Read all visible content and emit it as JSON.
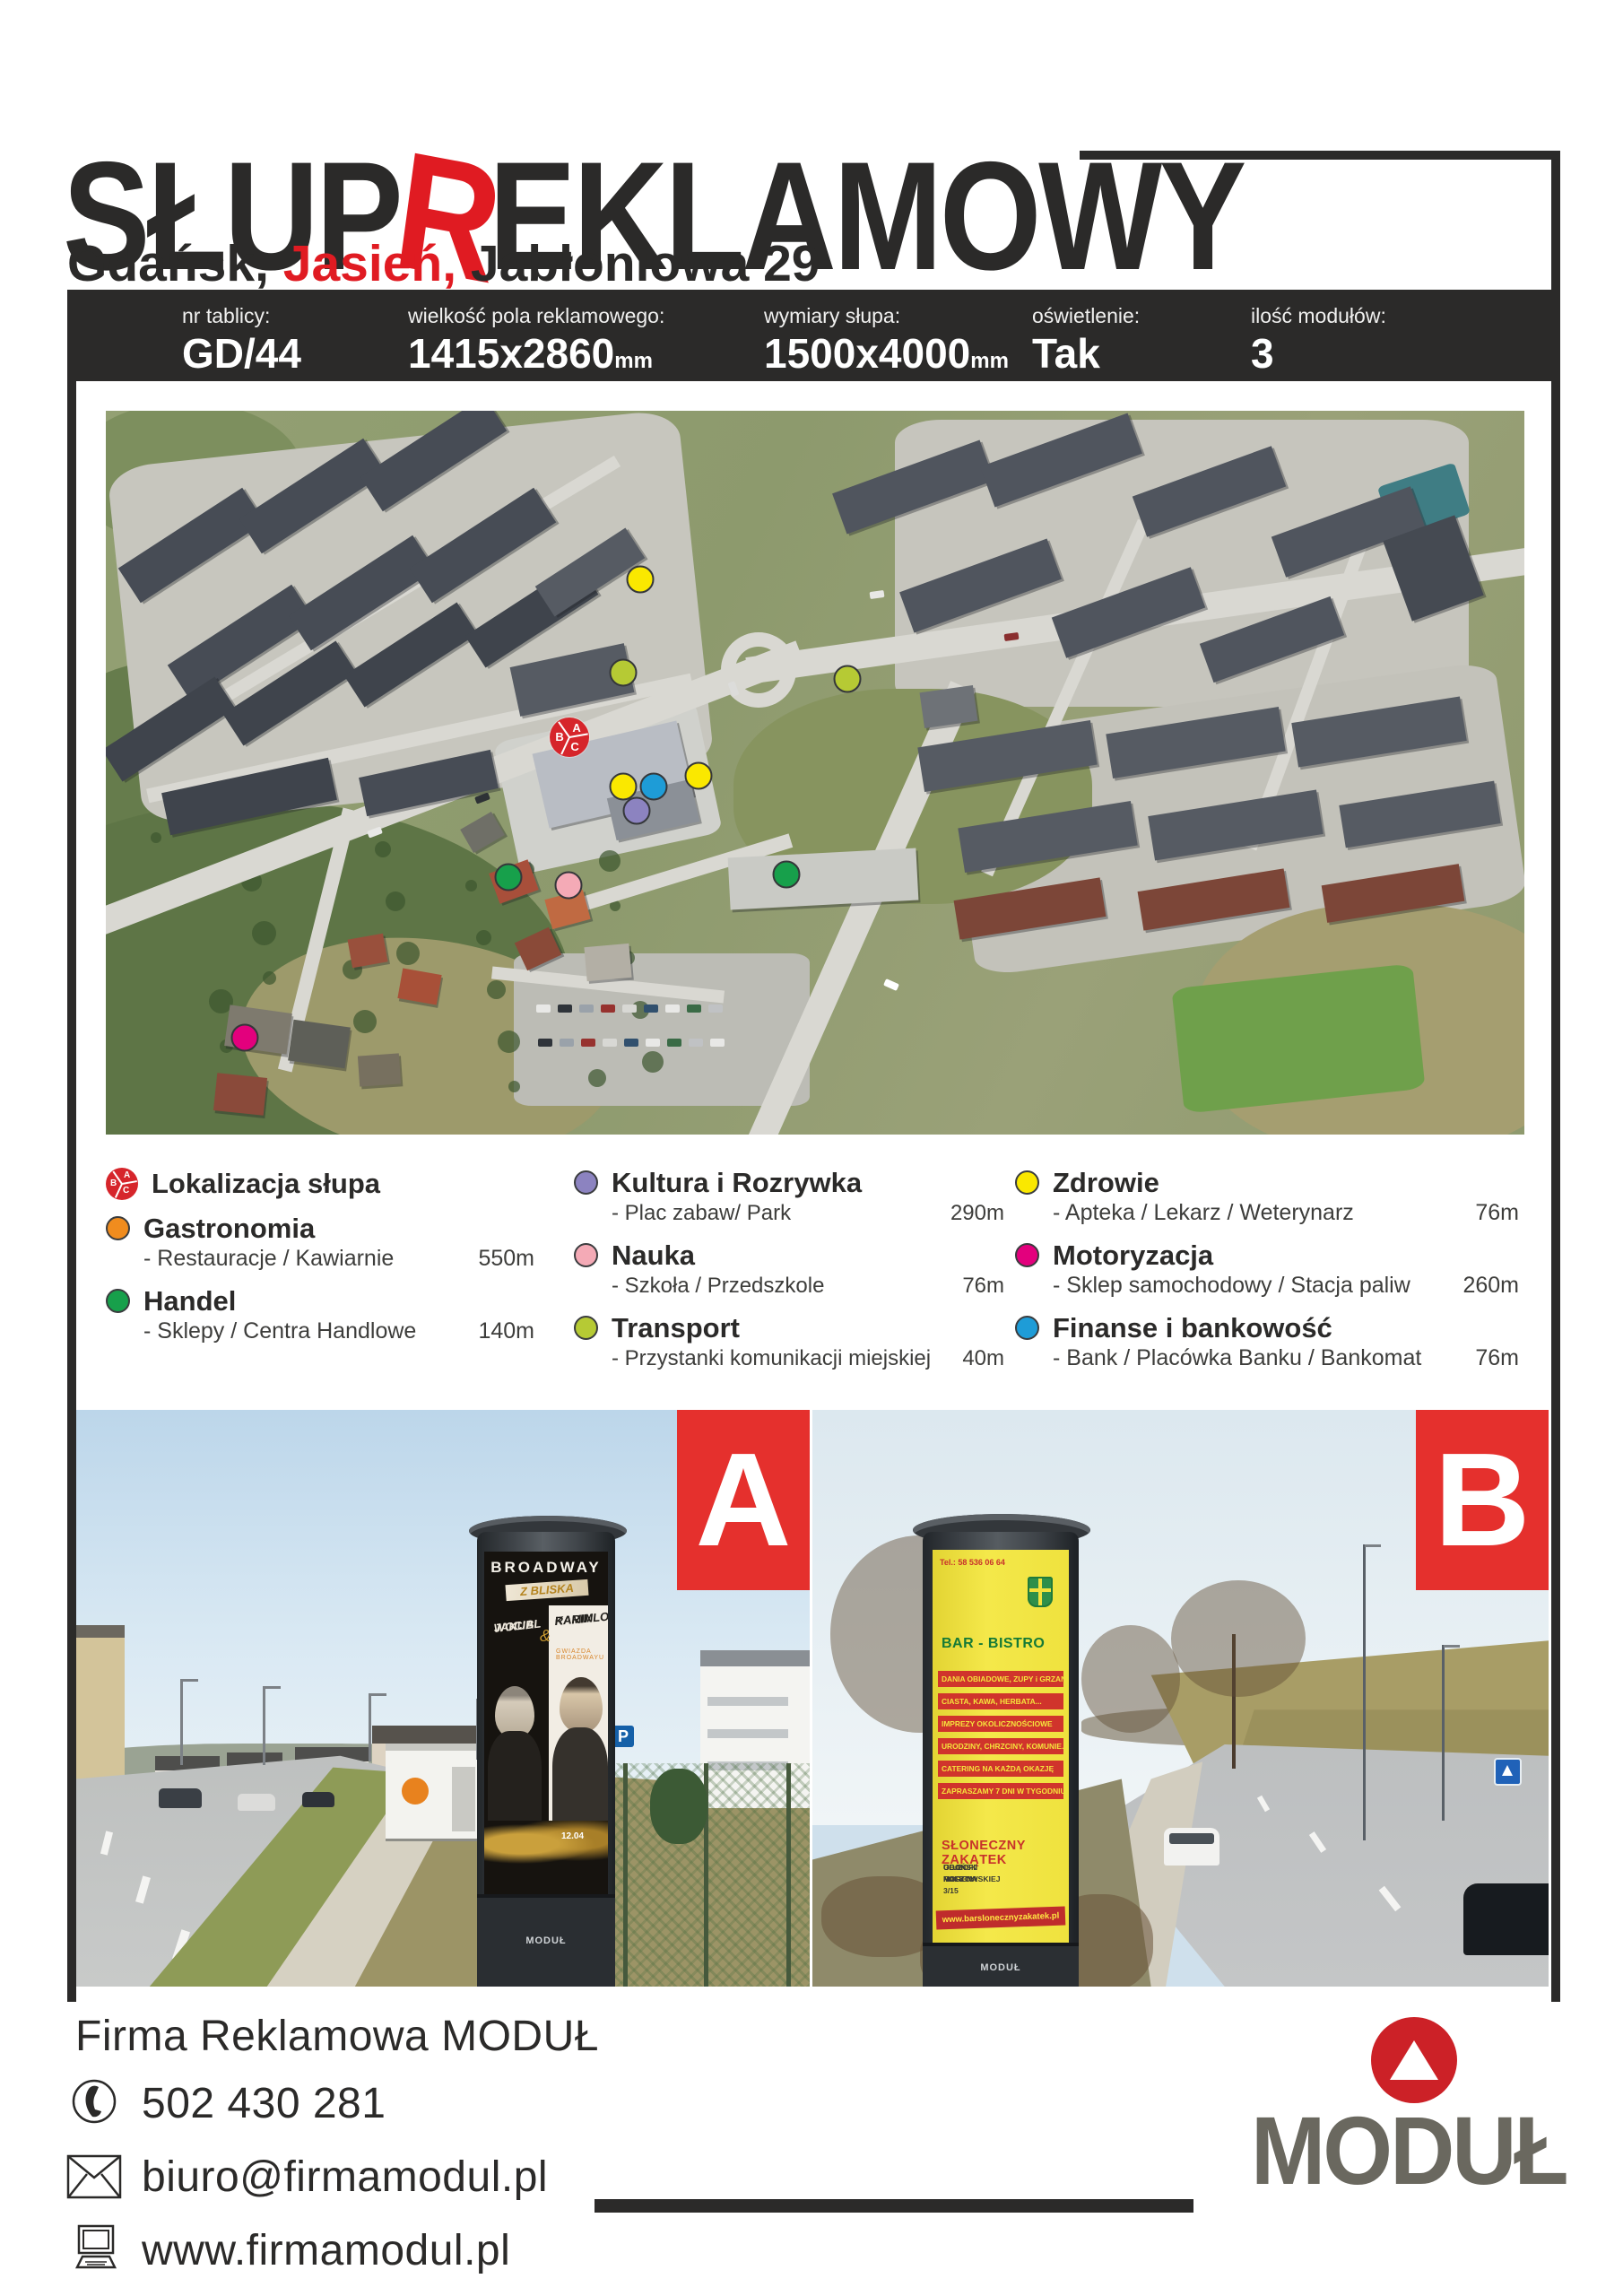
{
  "page": {
    "background": "#ffffff",
    "ink": "#2b2a29",
    "accent_red": "#e01b22"
  },
  "header": {
    "title_part1": "SŁUP",
    "title_accent": "R",
    "title_part2": "EKLAMOWY",
    "subtitle_prefix": "Gdańsk, ",
    "subtitle_accent": "Jasień,",
    "subtitle_suffix": " Jabłoniowa 29"
  },
  "info_bar": {
    "fields": [
      {
        "label": "nr tablicy:",
        "value": "GD/44",
        "unit": ""
      },
      {
        "label": "wielkość pola reklamowego:",
        "value": "1415x2860",
        "unit": "mm"
      },
      {
        "label": "wymiary słupa:",
        "value": "1500x4000",
        "unit": "mm"
      },
      {
        "label": "oświetlenie:",
        "value": "Tak",
        "unit": ""
      },
      {
        "label": "ilość modułów:",
        "value": "3",
        "unit": ""
      }
    ]
  },
  "map": {
    "column_marker": {
      "letters": [
        "B",
        "A",
        "C"
      ],
      "color": "#d6252b"
    },
    "category_colors": {
      "column": "#d6252b",
      "gastronomia": "#f08c1e",
      "handel": "#17a04b",
      "kultura": "#8c83c0",
      "nauka": "#f4aab6",
      "transport": "#b6ca34",
      "zdrowie": "#fae800",
      "motoryzacja": "#e3007d",
      "finanse": "#1e9cd7"
    },
    "markers": [
      {
        "category": "column",
        "x": 32.7,
        "y": 45.1
      },
      {
        "category": "transport",
        "x": 36.5,
        "y": 36.2
      },
      {
        "category": "transport",
        "x": 52.3,
        "y": 37.1
      },
      {
        "category": "zdrowie",
        "x": 37.7,
        "y": 23.3
      },
      {
        "category": "zdrowie",
        "x": 36.5,
        "y": 51.9
      },
      {
        "category": "zdrowie",
        "x": 41.8,
        "y": 50.4
      },
      {
        "category": "finanse",
        "x": 38.6,
        "y": 51.9
      },
      {
        "category": "kultura",
        "x": 37.4,
        "y": 55.3
      },
      {
        "category": "handel",
        "x": 28.4,
        "y": 64.4
      },
      {
        "category": "handel",
        "x": 48.0,
        "y": 64.1
      },
      {
        "category": "nauka",
        "x": 32.6,
        "y": 65.5
      },
      {
        "category": "motoryzacja",
        "x": 9.8,
        "y": 86.6
      }
    ]
  },
  "legend": {
    "columns": [
      {
        "items": [
          {
            "name": "Lokalizacja słupa",
            "category": "column"
          },
          {
            "name": "Gastronomia",
            "desc": "- Restauracje / Kawiarnie",
            "dist": "550m",
            "category": "gastronomia"
          },
          {
            "name": "Handel",
            "desc": "- Sklepy / Centra Handlowe",
            "dist": "140m",
            "category": "handel"
          }
        ]
      },
      {
        "items": [
          {
            "name": "Kultura i Rozrywka",
            "desc": "- Plac zabaw/ Park",
            "dist": "290m",
            "category": "kultura"
          },
          {
            "name": "Nauka",
            "desc": "- Szkoła / Przedszkole",
            "dist": "76m",
            "category": "nauka"
          },
          {
            "name": "Transport",
            "desc": "- Przystanki komunikacji miejskiej",
            "dist": "40m",
            "category": "transport"
          }
        ]
      },
      {
        "items": [
          {
            "name": "Zdrowie",
            "desc": "- Apteka / Lekarz / Weterynarz",
            "dist": "76m",
            "category": "zdrowie"
          },
          {
            "name": "Motoryzacja",
            "desc": "- Sklep samochodowy / Stacja paliw",
            "dist": "260m",
            "category": "motoryzacja"
          },
          {
            "name": "Finanse i bankowość",
            "desc": "- Bank / Placówka Banku / Bankomat",
            "dist": "76m",
            "category": "finanse"
          }
        ]
      }
    ]
  },
  "photo_a": {
    "label": "A",
    "poster": {
      "title": "BROADWAY",
      "subtitle": "Z BLISKA",
      "artist_left_1": "JAKUB",
      "artist_left_2": "WOCIAL",
      "ampersand": "&",
      "artist_right_1": "RAMIN",
      "artist_right_2": "KARIMLOO",
      "tagline": "GWIAZDA BROADWAYU",
      "date": "12.04",
      "brand": "MODUŁ"
    }
  },
  "photo_b": {
    "label": "B",
    "poster": {
      "tel": "Tel.: 58 536 06 64",
      "heading": "BAR - BISTRO",
      "stripes": [
        "DANIA OBIADOWE, ZUPY i GRZANE",
        "CIASTA, KAWA, HERBATA...",
        "IMPREZY OKOLICZNOŚCIOWE",
        "URODZINY, CHRZCINY, KOMUNIE...",
        "CATERING NA KAŻDĄ OKAZJĘ",
        "ZAPRASZAMY 7 DNI W TYGODNIU"
      ],
      "venue": "SŁONECZNY ZAKĄTEK",
      "address_1": "GDAŃSK MORENA",
      "address_2": "UL. ZOFII NAŁKOWSKIEJ 3/15",
      "address_3": "OBOK POCZTY",
      "url": "www.barslonecznyzakatek.pl",
      "brand": "MODUŁ"
    }
  },
  "footer": {
    "company": "Firma Reklamowa MODUŁ",
    "phone": "502 430 281",
    "email": "biuro@firmamodul.pl",
    "website": "www.firmamodul.pl",
    "logo_text": "MODUŁ"
  }
}
